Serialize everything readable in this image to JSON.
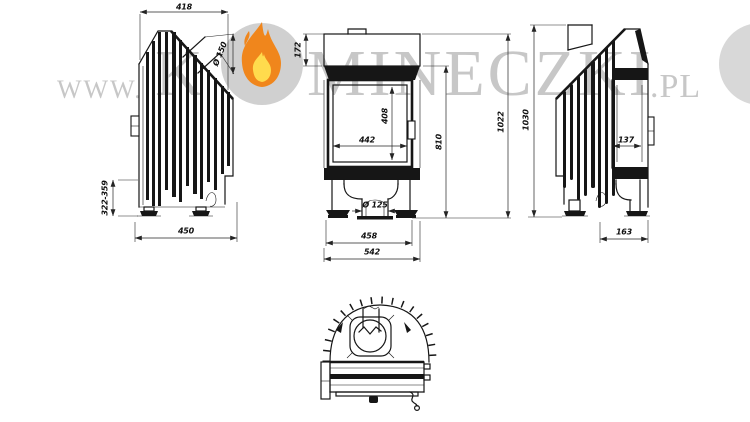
{
  "watermark": {
    "prefix": "WWW.",
    "letter_before_flame": "K",
    "letters_after_flame": "MINECZKI",
    "suffix": ".PL",
    "colors": {
      "text": "#c7c7c7",
      "circle": "#d0d0d0",
      "circle_partial": "#d8d8d8",
      "flame_outer": "#f0861c",
      "flame_inner": "#ffdb4d"
    }
  },
  "drawing": {
    "left_side_view": {
      "dims": {
        "top_depth": "418",
        "flue_diameter": "Ø 150",
        "base_height_range": "322-359",
        "depth": "450"
      }
    },
    "front_view": {
      "dims": {
        "hood_height": "172",
        "glass_width": "442",
        "glass_height": "408",
        "firebox_height": "810",
        "total_height": "1022",
        "air_inlet_diameter": "Ø 125",
        "feet_span": "458",
        "total_width": "542"
      }
    },
    "right_side_view": {
      "dims": {
        "total_height": "1030",
        "glass_depth": "137",
        "foot_width": "163"
      }
    }
  }
}
